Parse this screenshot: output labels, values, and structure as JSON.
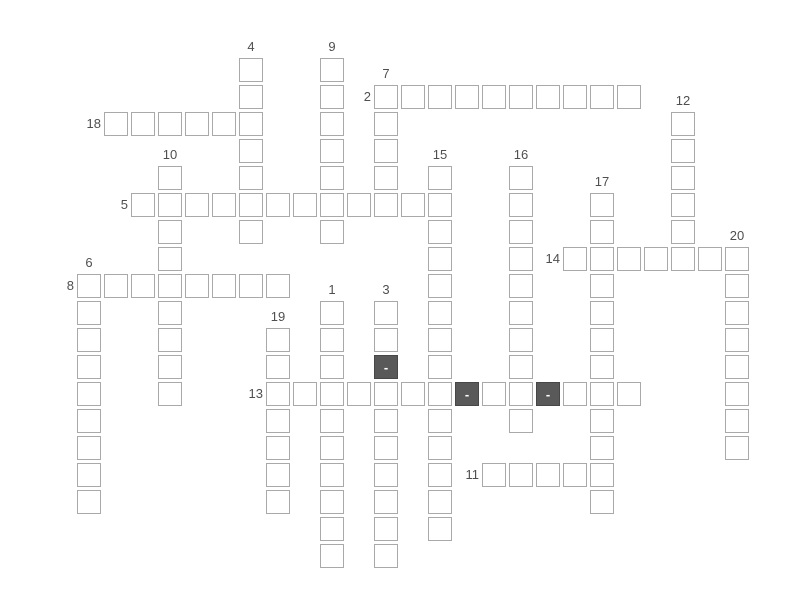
{
  "page": {
    "width": 800,
    "height": 600,
    "background": "#ffffff"
  },
  "crossword": {
    "origin_x": 77,
    "origin_y": 58,
    "cell_size": 24,
    "cell_step": 27,
    "colors": {
      "cell_fill": "#ffffff",
      "cell_border": "#a9a9a9",
      "filled_cell_fill": "#595959",
      "filled_cell_border": "#474747",
      "filled_cell_text": "#ffffff",
      "clue_number_text": "#4f4f4f"
    },
    "words": [
      {
        "number": 1,
        "direction": "down",
        "col": 9,
        "row": 9,
        "length": 10
      },
      {
        "number": 2,
        "direction": "across",
        "col": 11,
        "row": 1,
        "length": 10
      },
      {
        "number": 3,
        "direction": "down",
        "col": 11,
        "row": 9,
        "length": 10
      },
      {
        "number": 4,
        "direction": "down",
        "col": 6,
        "row": 0,
        "length": 7
      },
      {
        "number": 5,
        "direction": "across",
        "col": 2,
        "row": 5,
        "length": 12
      },
      {
        "number": 6,
        "direction": "down",
        "col": 0,
        "row": 8,
        "length": 9
      },
      {
        "number": 7,
        "direction": "down",
        "col": 11,
        "row": 1,
        "length": 5
      },
      {
        "number": 8,
        "direction": "across",
        "col": 0,
        "row": 8,
        "length": 8
      },
      {
        "number": 9,
        "direction": "down",
        "col": 9,
        "row": 0,
        "length": 7
      },
      {
        "number": 10,
        "direction": "down",
        "col": 3,
        "row": 4,
        "length": 9
      },
      {
        "number": 11,
        "direction": "across",
        "col": 15,
        "row": 15,
        "length": 5
      },
      {
        "number": 12,
        "direction": "down",
        "col": 22,
        "row": 2,
        "length": 6
      },
      {
        "number": 13,
        "direction": "across",
        "col": 7,
        "row": 12,
        "length": 14
      },
      {
        "number": 14,
        "direction": "across",
        "col": 18,
        "row": 7,
        "length": 7
      },
      {
        "number": 15,
        "direction": "down",
        "col": 13,
        "row": 4,
        "length": 14
      },
      {
        "number": 16,
        "direction": "down",
        "col": 16,
        "row": 4,
        "length": 10
      },
      {
        "number": 17,
        "direction": "down",
        "col": 19,
        "row": 5,
        "length": 12
      },
      {
        "number": 18,
        "direction": "across",
        "col": 1,
        "row": 2,
        "length": 6
      },
      {
        "number": 19,
        "direction": "down",
        "col": 7,
        "row": 10,
        "length": 7
      },
      {
        "number": 20,
        "direction": "down",
        "col": 24,
        "row": 7,
        "length": 8
      }
    ],
    "filled_cells": [
      {
        "col": 11,
        "row": 11,
        "text": "-"
      },
      {
        "col": 14,
        "row": 12,
        "text": "-"
      },
      {
        "col": 17,
        "row": 12,
        "text": "-"
      }
    ]
  }
}
